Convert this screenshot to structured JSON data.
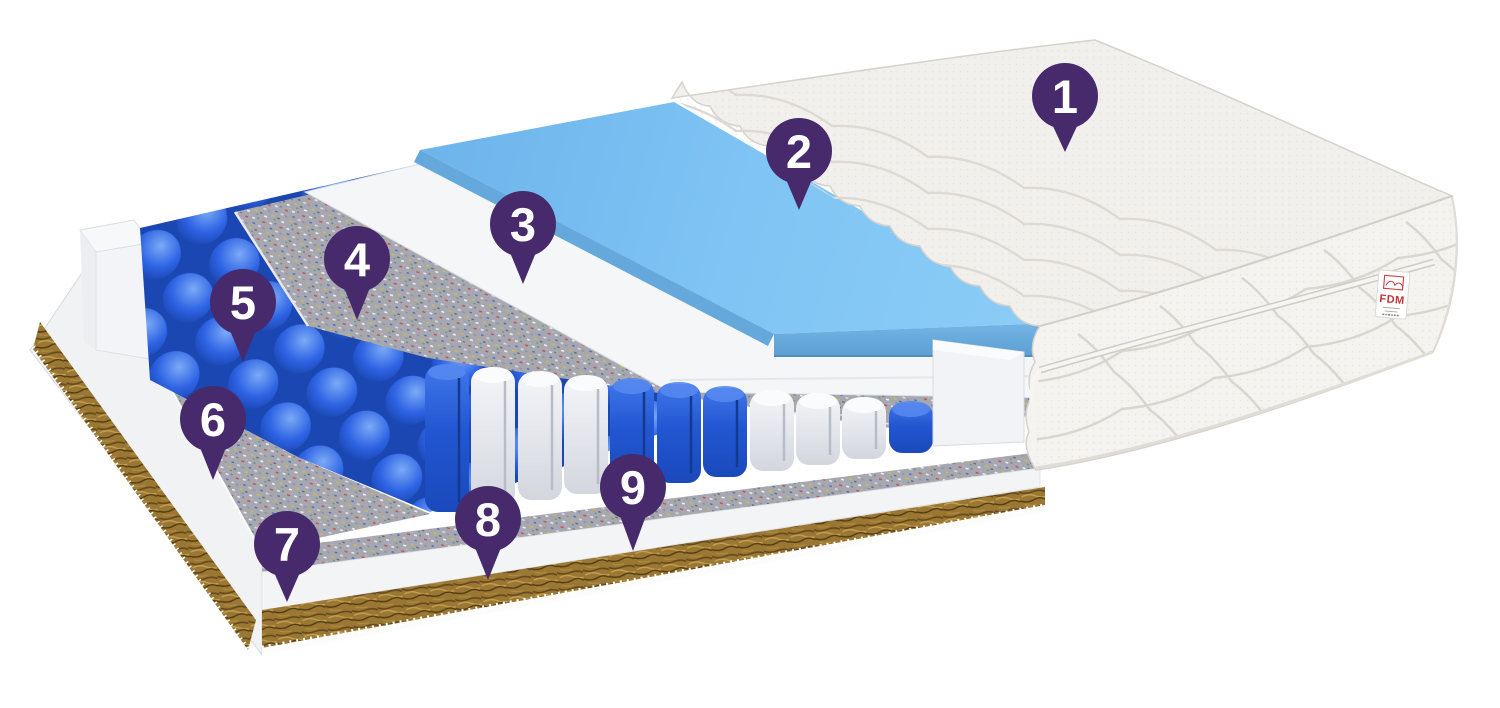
{
  "callouts": [
    {
      "number": "1"
    },
    {
      "number": "2"
    },
    {
      "number": "3"
    },
    {
      "number": "4"
    },
    {
      "number": "5"
    },
    {
      "number": "6"
    },
    {
      "number": "7"
    },
    {
      "number": "8"
    },
    {
      "number": "9"
    }
  ],
  "brand_tag": {
    "text": "FDM"
  },
  "colors": {
    "badge_purple": "#462a6b",
    "brand_red": "#c23434",
    "foam_blue": "#79bff2",
    "spring_blue": "#2257d8",
    "coir_brown": "#9a7733",
    "felt_gray": "#a7a7af",
    "cover_white": "#f2f0ec"
  }
}
